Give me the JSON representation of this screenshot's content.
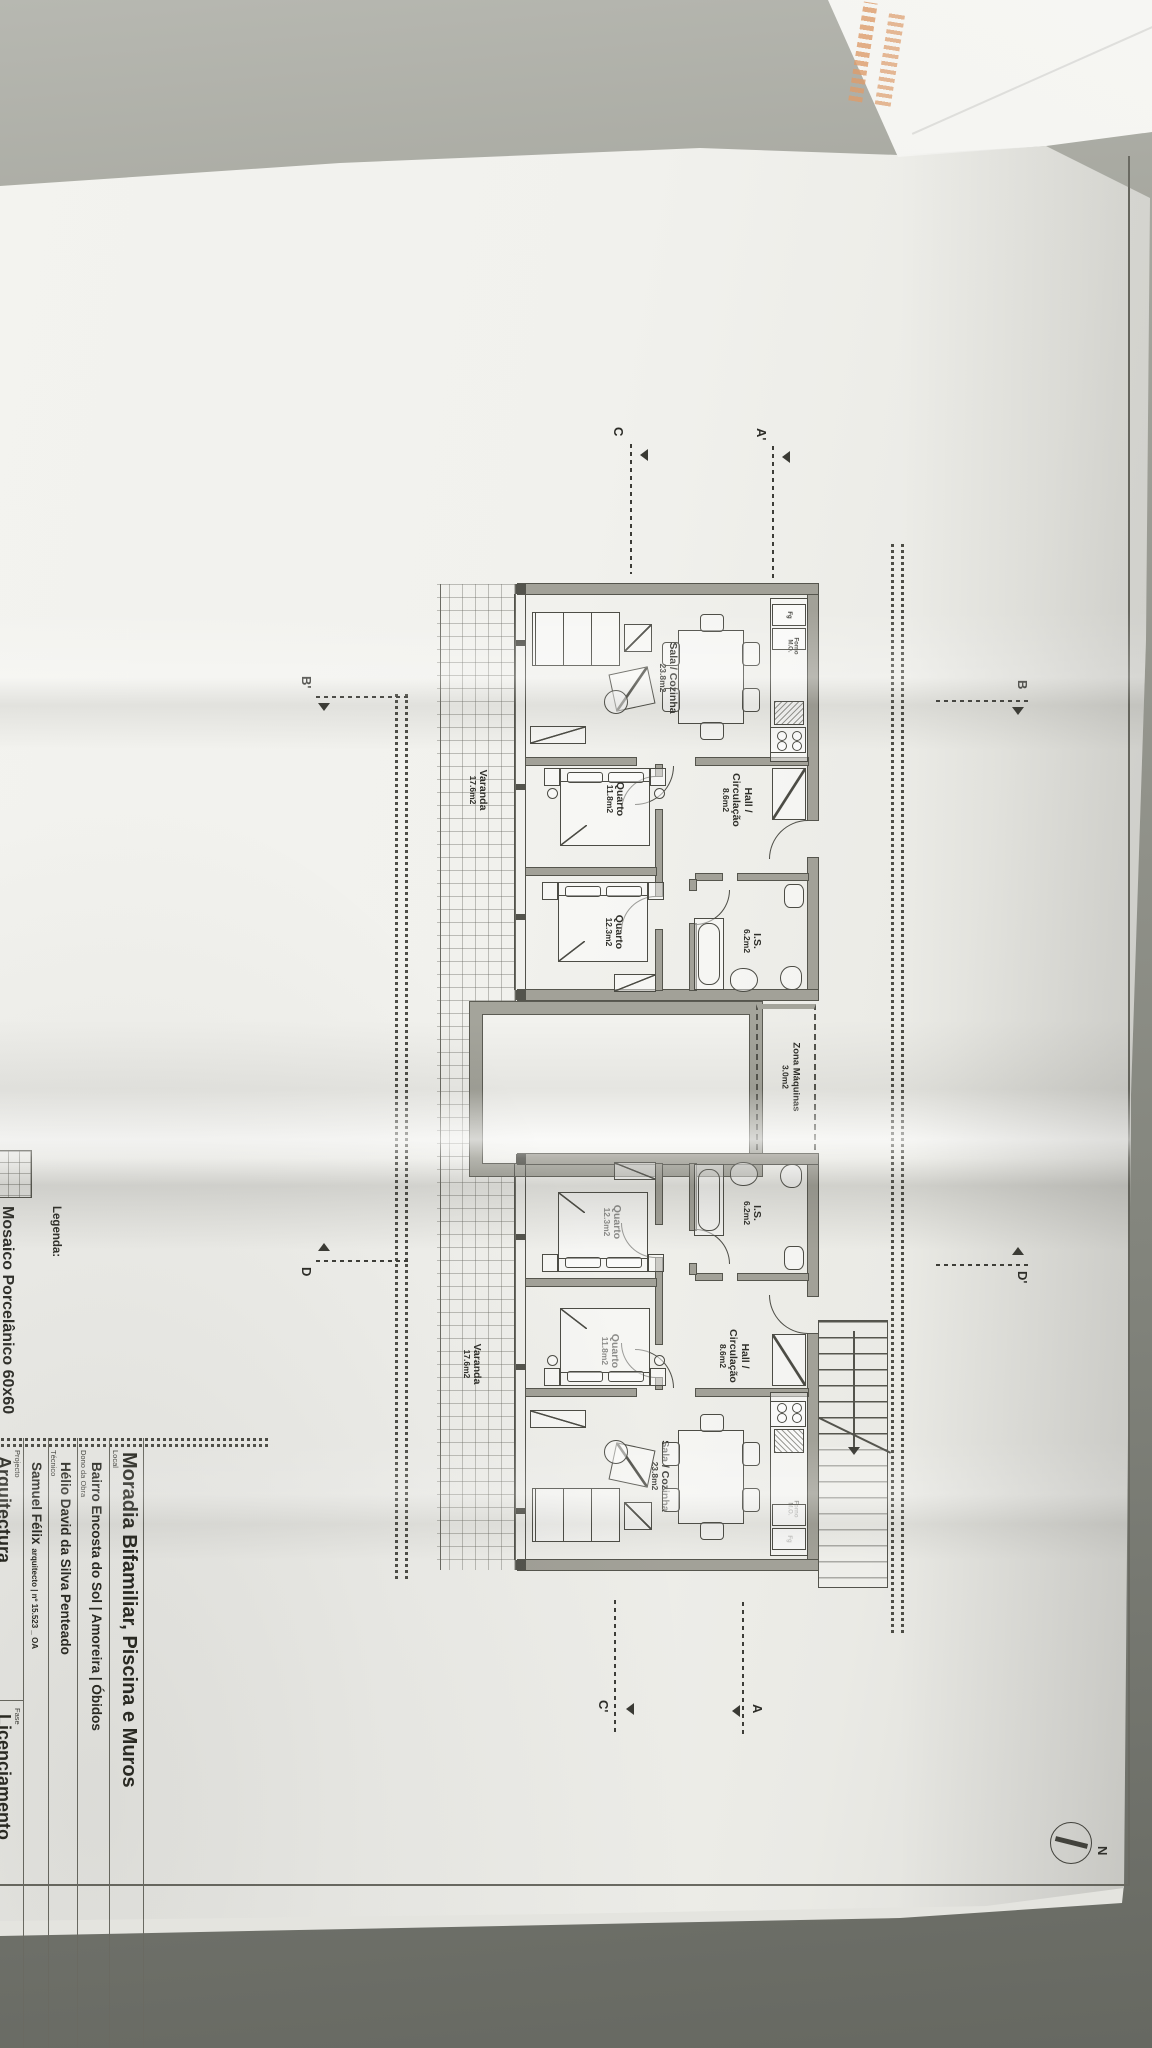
{
  "photo": {
    "desk_color_top": "#b7b8b1",
    "desk_color_bottom": "#666861",
    "paper_color": "#f1f1ed",
    "envelope_color": "#f3f3f0",
    "envelope_print_color": "#dd9c6b",
    "ink_color": "#53534c"
  },
  "plan": {
    "rooms": [
      {
        "lines": [
          "Sala / Cozinha",
          "23.8m2"
        ]
      },
      {
        "lines": [
          "Hall /",
          "Circulação",
          "8.6m2"
        ]
      },
      {
        "lines": [
          "Quarto",
          "11.8m2"
        ]
      },
      {
        "lines": [
          "Quarto",
          "12.3m2"
        ]
      },
      {
        "lines": [
          "I.S.",
          "6.2m2"
        ]
      },
      {
        "lines": [
          "Varanda",
          "17.6m2"
        ]
      },
      {
        "lines": [
          "Zona Máquinas",
          "3.0m2"
        ]
      }
    ],
    "kitchen": {
      "fridge": "Fg",
      "oven_l1": "Forno",
      "oven_l2": "M.O."
    },
    "markers": [
      {
        "label": "A'"
      },
      {
        "label": "C"
      },
      {
        "label": "B"
      },
      {
        "label": "D'"
      },
      {
        "label": "B'"
      },
      {
        "label": "D"
      },
      {
        "label": "A"
      },
      {
        "label": "C'"
      }
    ],
    "north_label": "N"
  },
  "legend": {
    "heading": "Legenda:",
    "item": "Mosaico Porcelânico 60x60"
  },
  "title_block": {
    "title": "Moradia Bifamiliar, Piscina e Muros",
    "rows": [
      {
        "label": "Local",
        "value": "Bairro Encosta do Sol | Amoreira | Óbidos"
      },
      {
        "label": "Dono da Obra",
        "value": "Hélio David da Silva Penteado"
      },
      {
        "label": "Técnico",
        "value": "Samuel Félix",
        "suffix": "arquitecto | nº 15.523 _ OA"
      },
      {
        "label": "Projecto",
        "value": "Arquitectura"
      },
      {
        "label": "Fase",
        "value": "Licenciamento"
      }
    ]
  }
}
